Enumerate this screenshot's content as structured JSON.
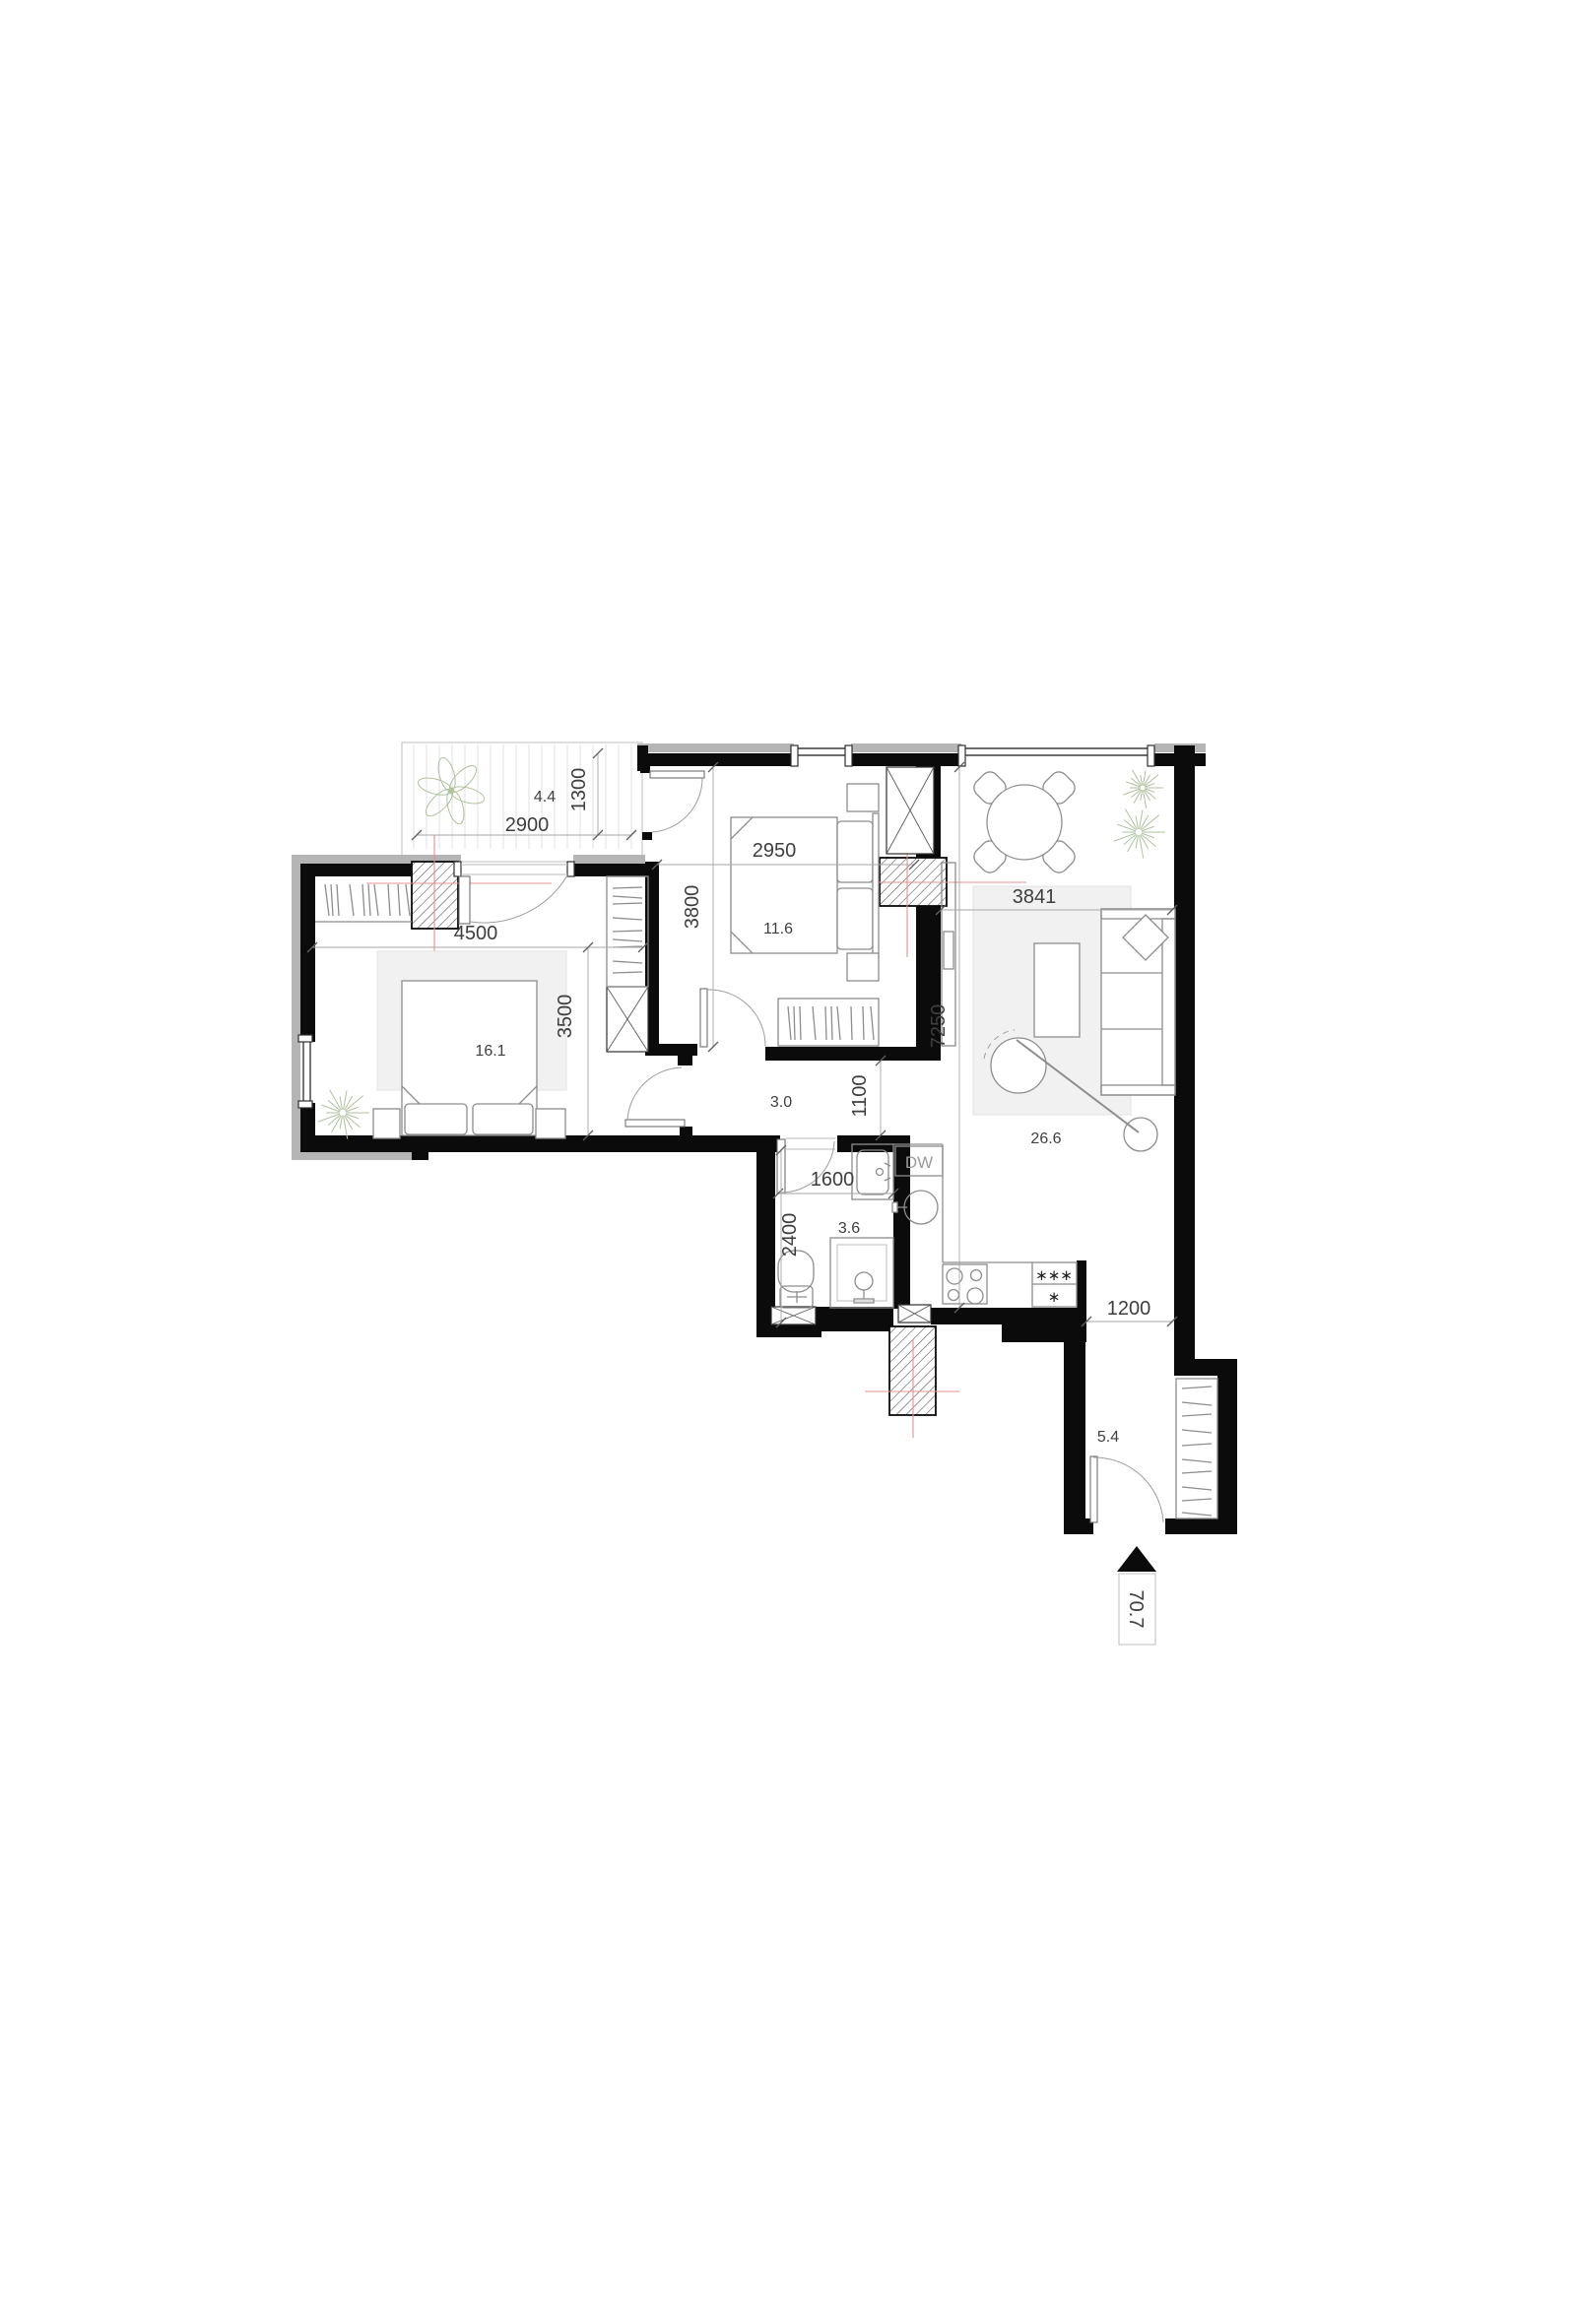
{
  "colors": {
    "wall": "#0b0b0b",
    "sill": "#b5b5b5",
    "furniture_line": "#8d8d8d",
    "dim_text": "#3e3e3e",
    "center_line_red": "#e59090",
    "plant_green": "#aec29f",
    "rug_gray": "#f1f1f1"
  },
  "rooms": {
    "terrace": {
      "area": "4.4"
    },
    "bedroom1": {
      "area": "16.1"
    },
    "bedroom2": {
      "area": "11.6"
    },
    "living": {
      "area": "26.6"
    },
    "hall": {
      "area": "3.0"
    },
    "bathroom": {
      "area": "3.6"
    },
    "entry": {
      "area": "5.4"
    }
  },
  "dimensions": {
    "terrace_width": "2900",
    "terrace_depth": "1300",
    "bedroom1_width": "4500",
    "bedroom1_depth": "3500",
    "bedroom2_width": "2950",
    "bedroom2_depth": "3800",
    "living_width": "3841",
    "living_depth": "7250",
    "hall_depth": "1100",
    "bathroom_width": "1600",
    "bathroom_depth": "2400",
    "entry_passage": "1200"
  },
  "labels": {
    "dishwasher": "DW",
    "fridge_freezer_top": "∗∗∗",
    "fridge_freezer_bottom": "∗",
    "total_area": "70.7"
  },
  "icons": {
    "entrance_marker": "filled-triangle-up",
    "plant_symbol": "starburst-plant",
    "column_symbol": "diagonal-hatch"
  }
}
